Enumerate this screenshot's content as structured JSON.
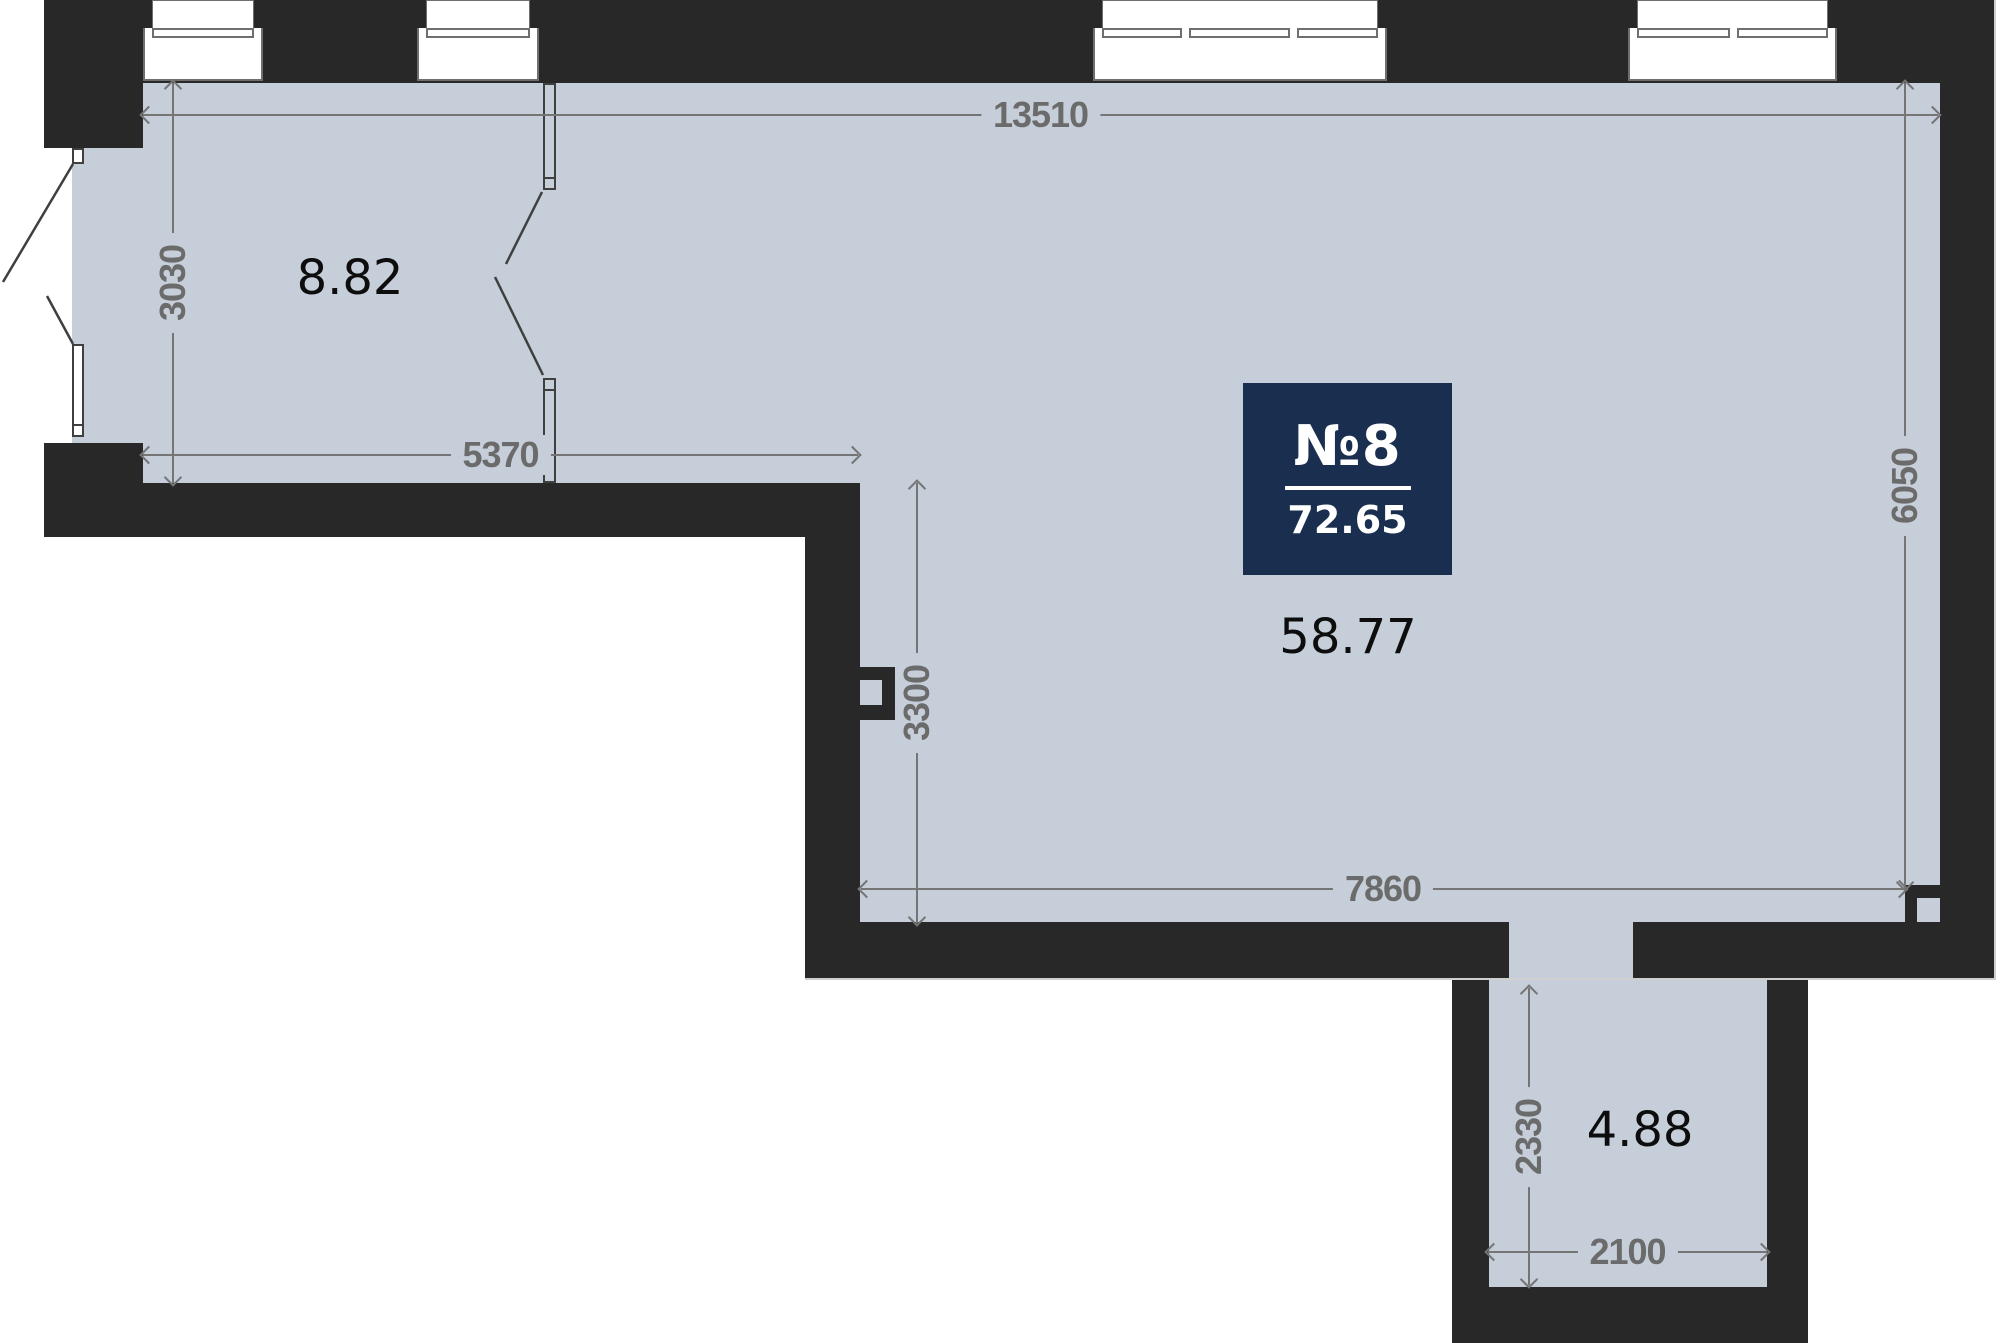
{
  "plan": {
    "unit_number": "№8",
    "total_area": "72.65",
    "rooms": {
      "room_top_left_area": "8.82",
      "room_main_area": "58.77",
      "room_bottom_area": "4.88"
    },
    "dimensions": {
      "top_width": "13510",
      "left_height": "3030",
      "room1_width": "5370",
      "right_height": "6050",
      "inner_wall_height": "3300",
      "bottom_width": "7860",
      "ext_height": "2330",
      "ext_width": "2100"
    }
  },
  "colors": {
    "background": "#ffffff",
    "wall": "#282828",
    "floor": "#c5ced9",
    "badge_bg": "#1a2f50",
    "badge_text": "#ffffff",
    "dim_text": "#6b6b6b",
    "dim_line": "#757575",
    "area_text": "#0d0d0d",
    "outline": "#3f3f3f",
    "window_fill": "#ffffff",
    "window_line": "#6f6f6f"
  }
}
